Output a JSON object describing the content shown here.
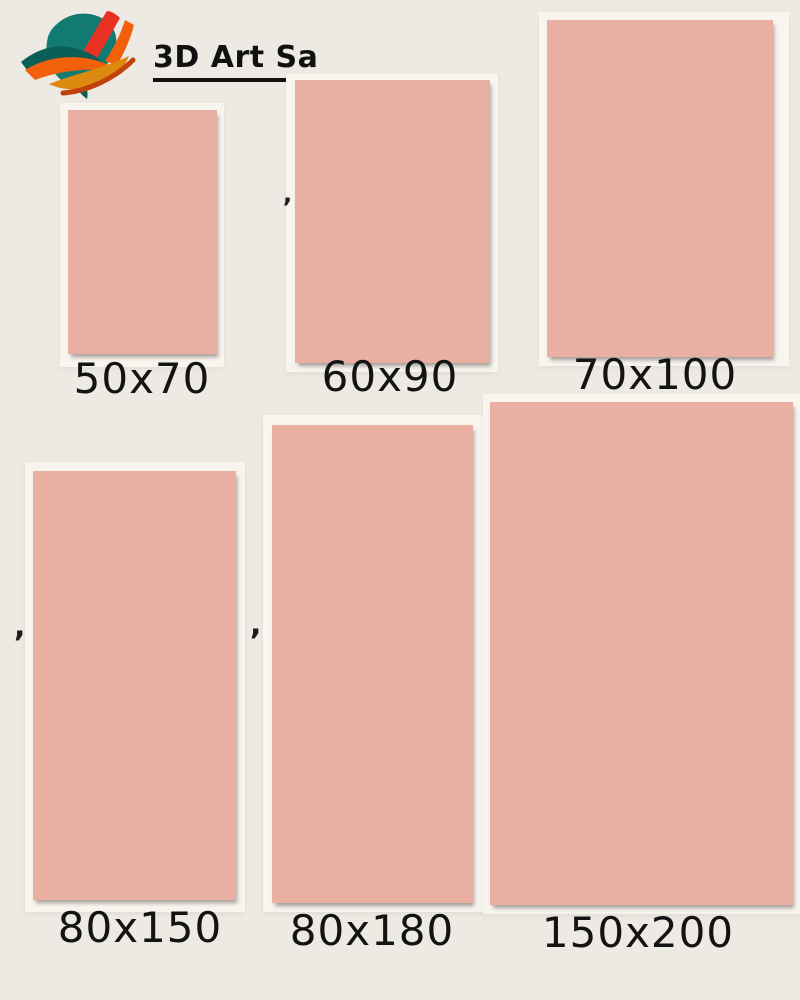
{
  "page": {
    "background_color": "#EDEAE3",
    "card_backing_color": "#F8F5EF",
    "swatch_color": "#E9AFA2",
    "text_color": "#131313"
  },
  "header": {
    "brand_name": "3D Art Sa",
    "logo": {
      "icon_name": "paint-brush-flower-logo",
      "teal": "#117B72",
      "teal_dark": "#0C5F58",
      "red": "#E93223",
      "orange": "#F2600C",
      "amber": "#DD8A10",
      "burnt_orange": "#C2410C"
    }
  },
  "sizes": {
    "items": [
      {
        "label": "50x70"
      },
      {
        "label": "60x90"
      },
      {
        "label": "70x100"
      },
      {
        "label": "80x150"
      },
      {
        "label": "80x180"
      },
      {
        "label": "150x200"
      }
    ]
  },
  "decorations": {
    "comma": ","
  }
}
